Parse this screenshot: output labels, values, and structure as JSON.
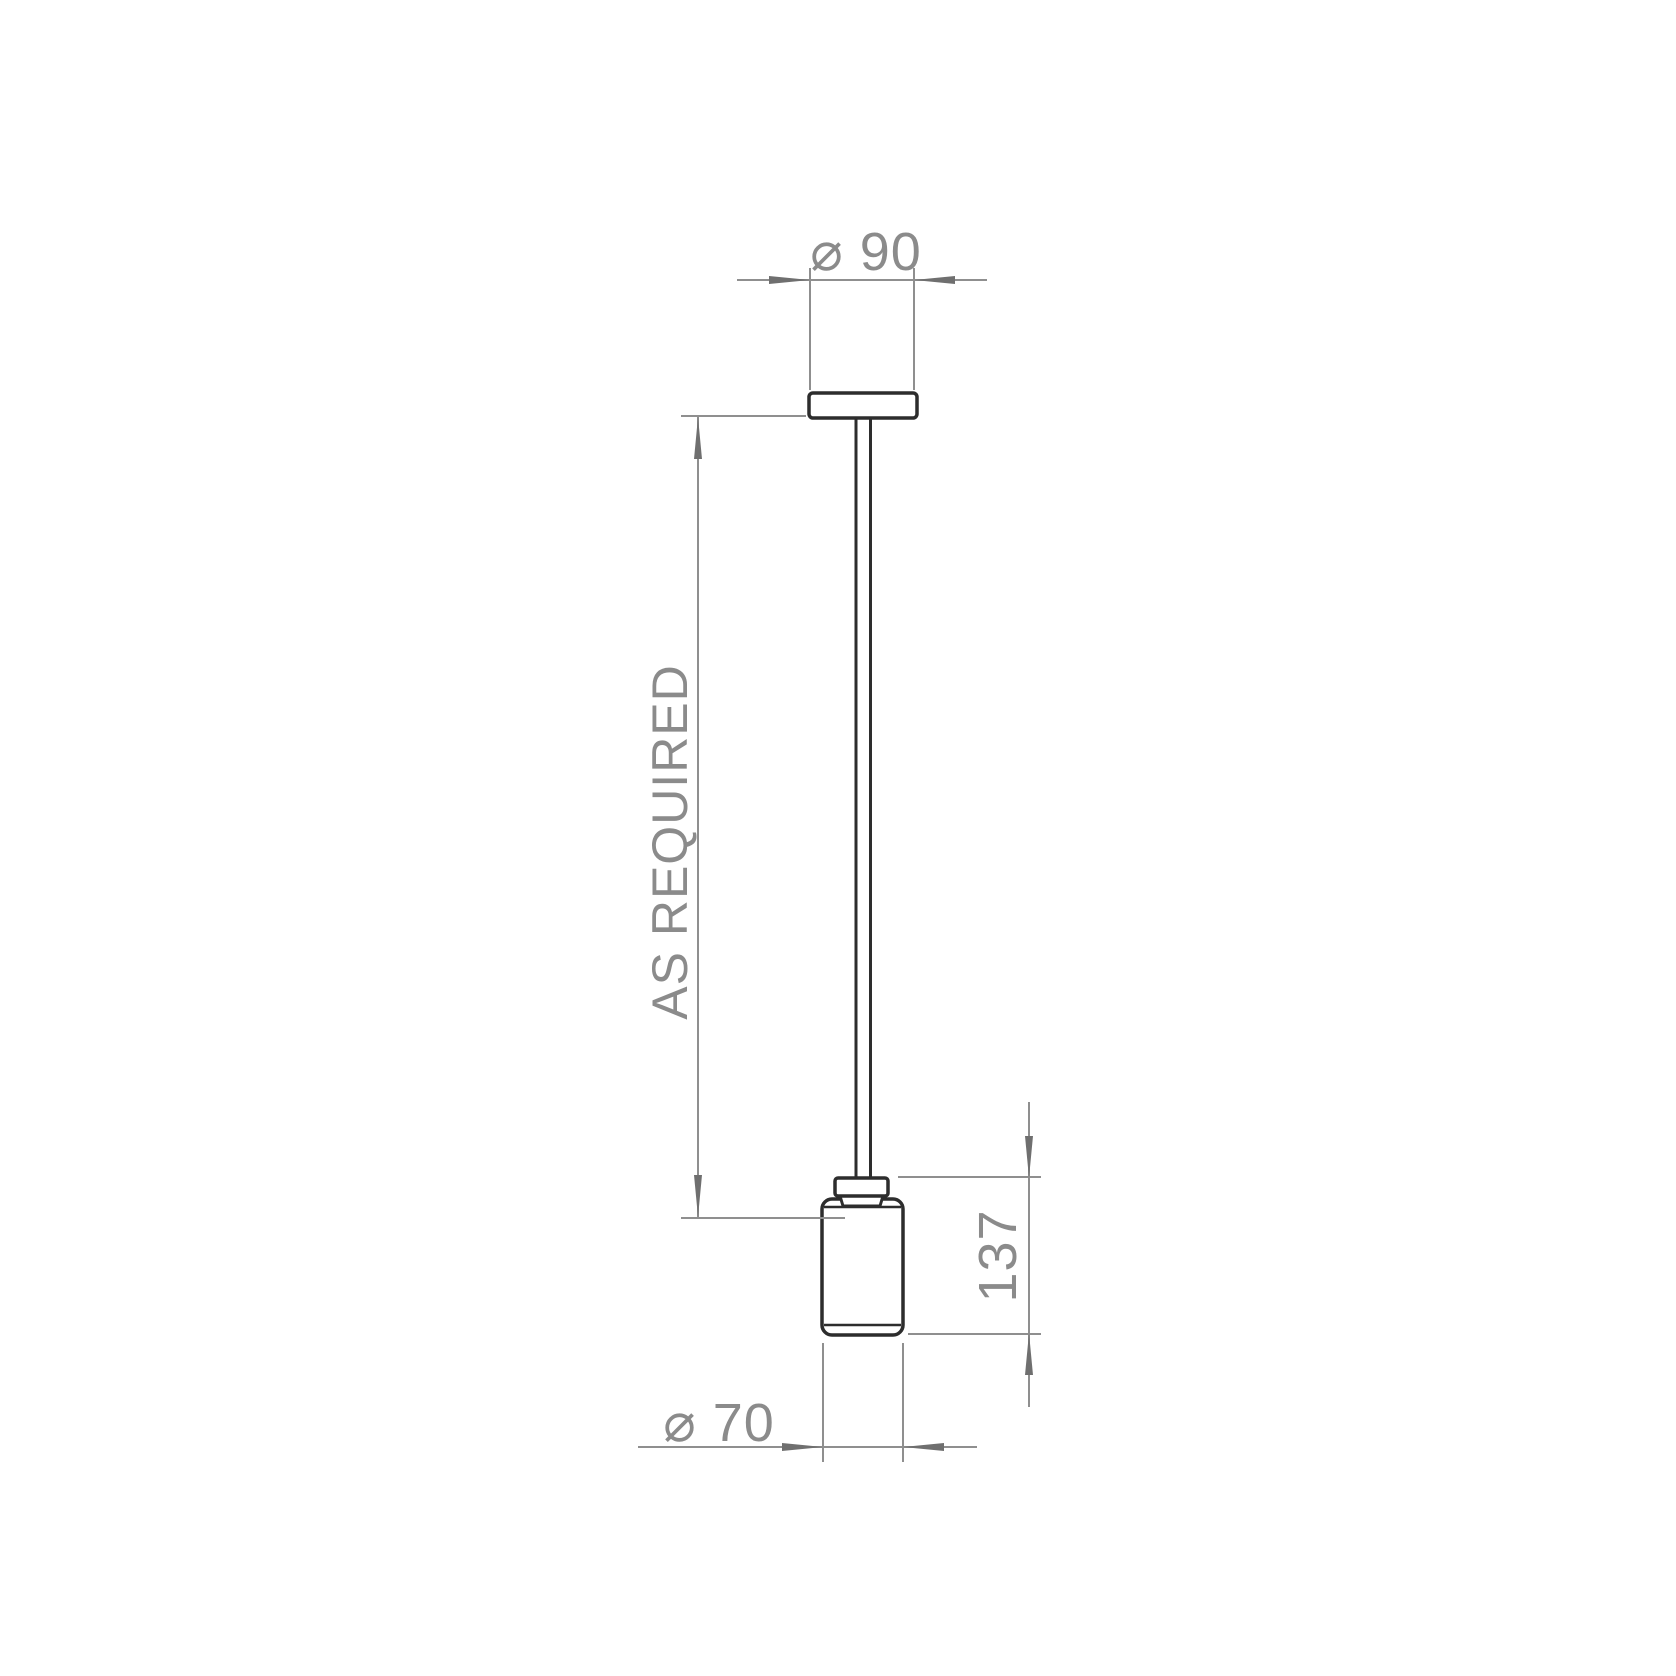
{
  "drawing": {
    "colors": {
      "background": "#ffffff",
      "object_outline": "#2d2d2d",
      "dimension": "#8f8f8f"
    },
    "labels": {
      "top_diameter": "⌀ 90",
      "drop_length": "AS REQUIRED",
      "shade_height": "137",
      "shade_diameter": "⌀ 70"
    }
  }
}
